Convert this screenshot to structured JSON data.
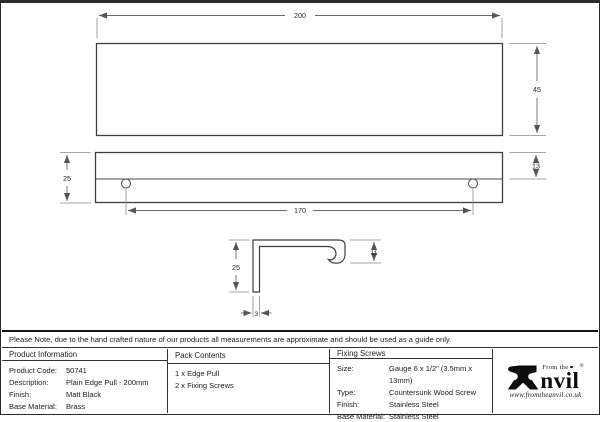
{
  "note": "Please Note, due to the hand crafted nature of our products all measurements are approximate and should be used as a guide only.",
  "drawing": {
    "top_view": {
      "width": "200",
      "height": "45"
    },
    "front_view": {
      "depth": "25",
      "top_section": "13",
      "hole_spacing": "170"
    },
    "profile": {
      "height": "25",
      "hook_depth": "11",
      "thickness": "3"
    }
  },
  "table": {
    "product_information": {
      "header": "Product Information",
      "rows": [
        {
          "label": "Product Code:",
          "value": "50741"
        },
        {
          "label": "Description:",
          "value": "Plain Edge Pull - 200mm"
        },
        {
          "label": "Finish:",
          "value": "Matt Black"
        },
        {
          "label": "Base Material:",
          "value": "Brass"
        }
      ]
    },
    "pack_contents": {
      "header": "Pack Contents",
      "items": [
        "1 x Edge Pull",
        "2 x Fixing Screws"
      ]
    },
    "fixing_screws": {
      "header": "Fixing Screws",
      "rows": [
        {
          "label": "Size:",
          "value": "Gauge 6 x 1/2\" (3.5mm x 13mm)"
        },
        {
          "label": "Type:",
          "value": "Countersunk Wood Screw"
        },
        {
          "label": "Finish:",
          "value": "Stainless Steel"
        },
        {
          "label": "Base Material:",
          "value": "Stainless Steel"
        }
      ]
    }
  },
  "logo": {
    "tagline": "From the",
    "name_rest": "nvil",
    "registered": "®",
    "url": "www.fromtheanvil.co.uk"
  },
  "colors": {
    "line": "#3f3f3f",
    "dim": "#6a6a6a",
    "ink": "#1c1c1c"
  }
}
